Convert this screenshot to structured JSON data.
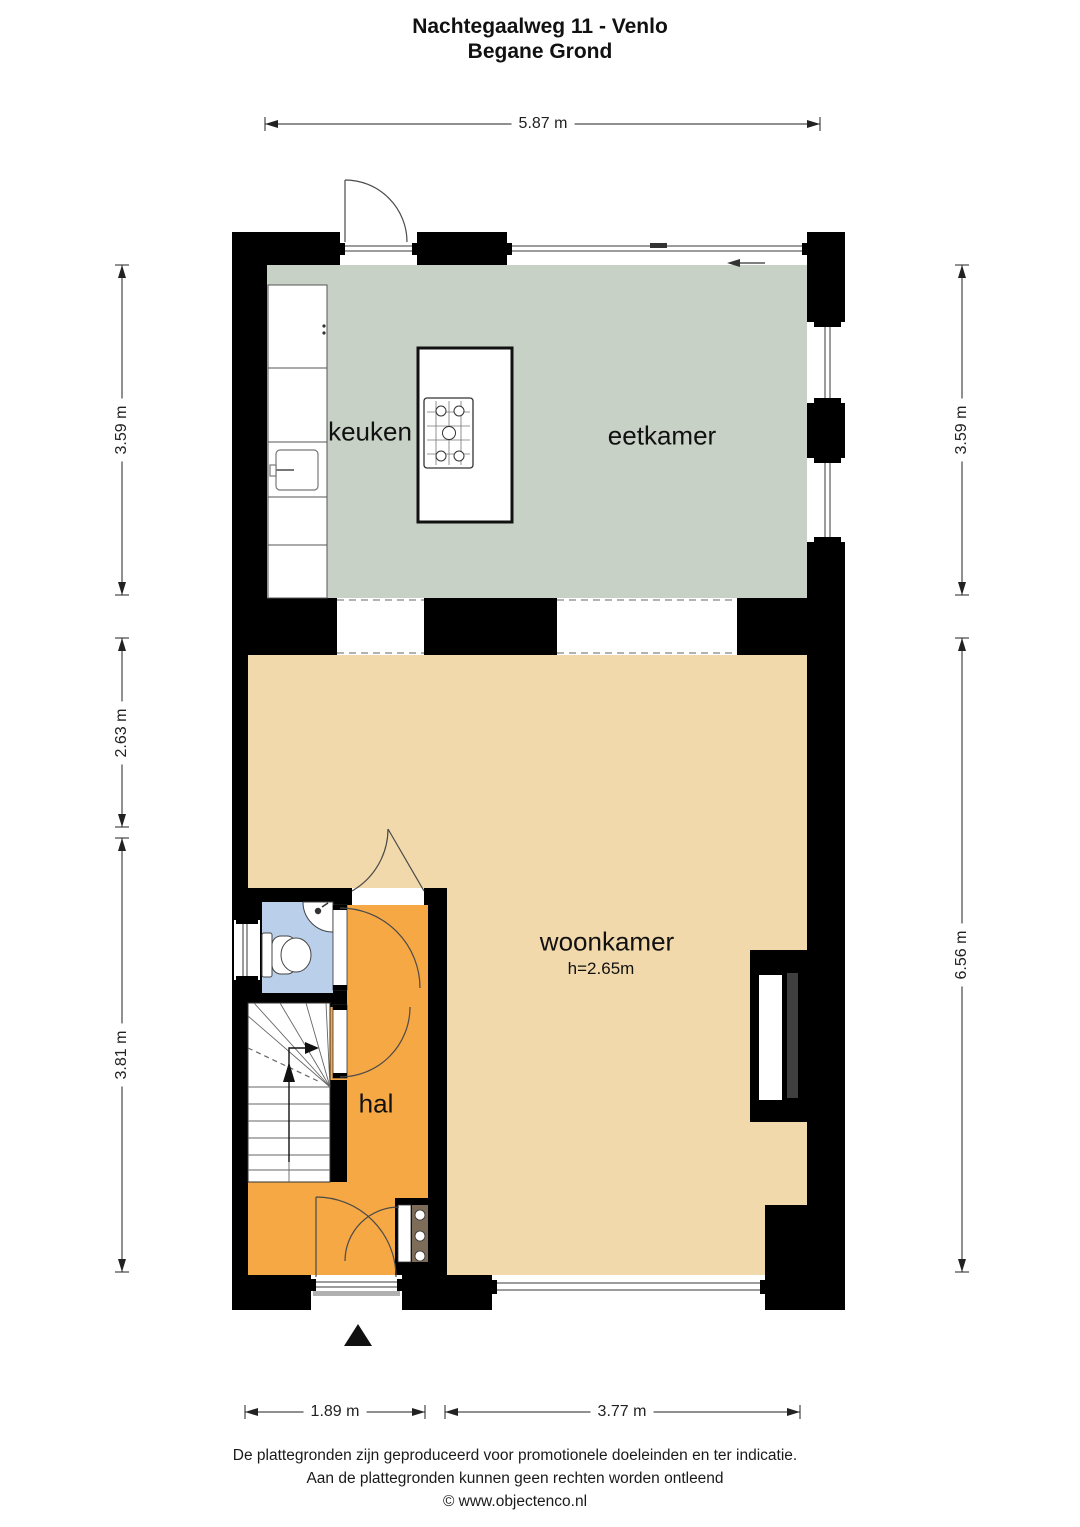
{
  "title": {
    "line1": "Nachtegaalweg 11 - Venlo",
    "line2": "Begane Grond"
  },
  "rooms": {
    "keuken": {
      "label": "keuken"
    },
    "eetkamer": {
      "label": "eetkamer"
    },
    "woonkamer": {
      "label": "woonkamer",
      "ceiling_height": "h=2.65m"
    },
    "hal": {
      "label": "hal"
    }
  },
  "dimensions": {
    "top": "5.87 m",
    "left_top": "3.59 m",
    "left_middle": "2.63 m",
    "left_bottom": "3.81 m",
    "right_top": "3.59 m",
    "right_bottom": "6.56 m",
    "bottom_left": "1.89 m",
    "bottom_right": "3.77 m"
  },
  "footer": {
    "line1": "De plattegronden zijn geproduceerd voor promotionele doeleinden en ter indicatie.",
    "line2": "Aan de plattegronden kunnen geen rechten worden ontleend",
    "line3": "© www.objectenco.nl"
  },
  "colors": {
    "kitchen_dining": "#c8d1c5",
    "living_room": "#f2d9ab",
    "hall": "#f5a844",
    "toilet": "#bacfe9",
    "wall": "#000000",
    "meter_cupboard": "#7d6c58"
  }
}
